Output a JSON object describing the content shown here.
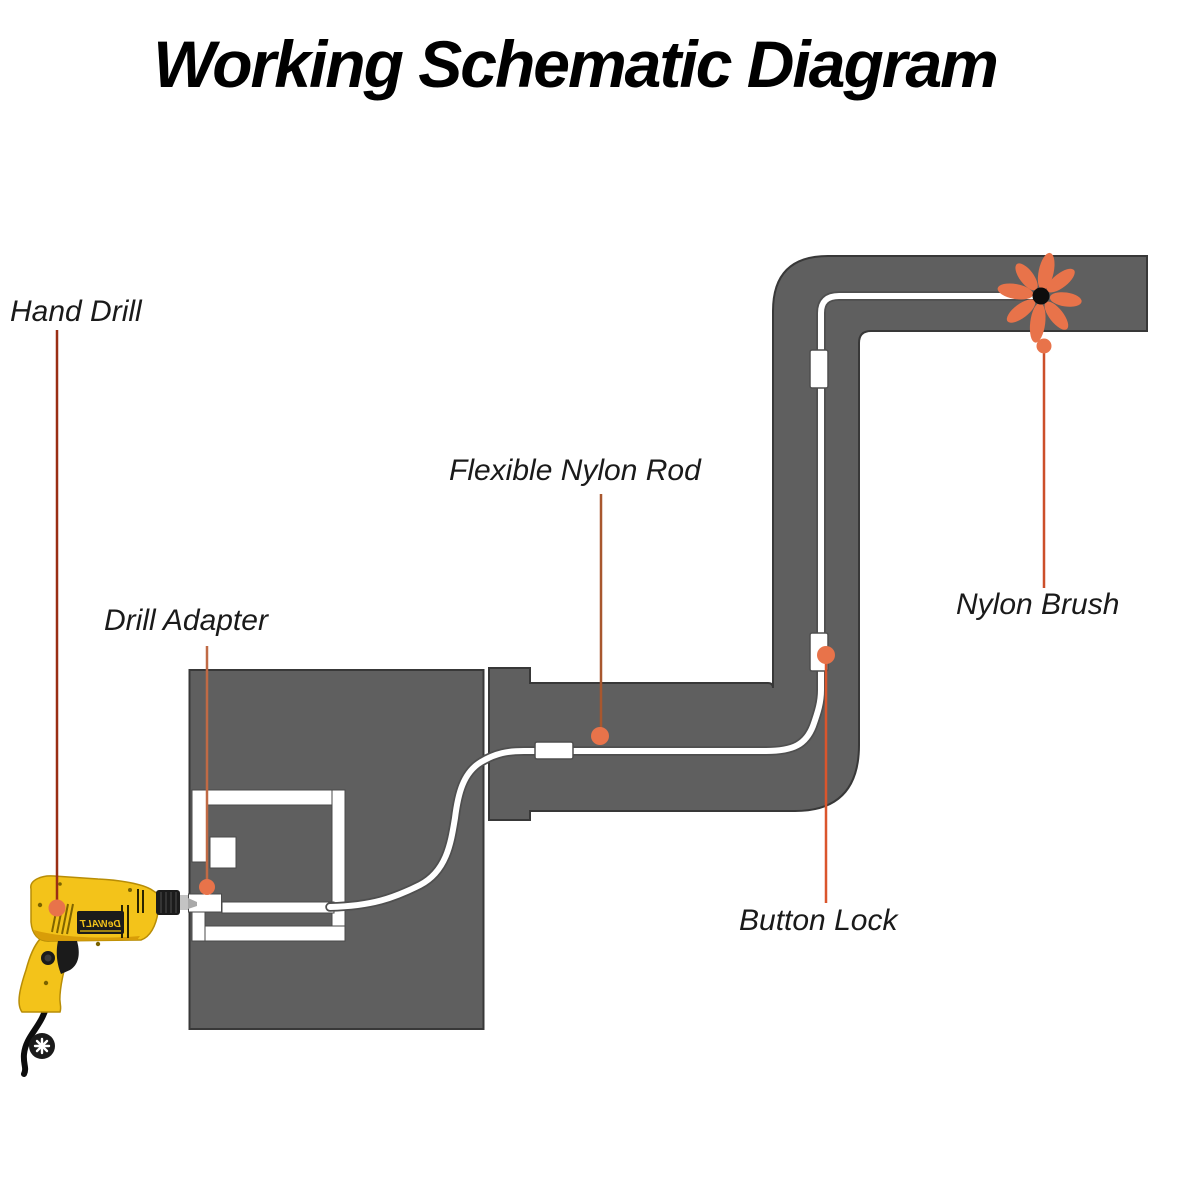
{
  "title": "Working Schematic Diagram",
  "labels": {
    "hand_drill": "Hand Drill",
    "drill_adapter": "Drill Adapter",
    "flexible_nylon_rod": "Flexible Nylon Rod",
    "nylon_brush": "Nylon Brush",
    "button_lock": "Button Lock"
  },
  "drill_brand": "DeWALT",
  "colors": {
    "duct": "#5f5f5f",
    "duct-border": "#383838",
    "accent": "#e8734a",
    "rod-outline": "#4f4f4f",
    "label-text": "#1a1a1a",
    "line-hand-drill": "#9a2e14",
    "line-drill-adapter": "#c06a45",
    "line-flexible-rod": "#a8572e",
    "line-nylon-brush": "#cc4f2a",
    "line-button-lock": "#da552c",
    "drill-yellow": "#f3c31a",
    "drill-yellow-dark": "#d89d08",
    "drill-dark": "#1b1b1b"
  }
}
